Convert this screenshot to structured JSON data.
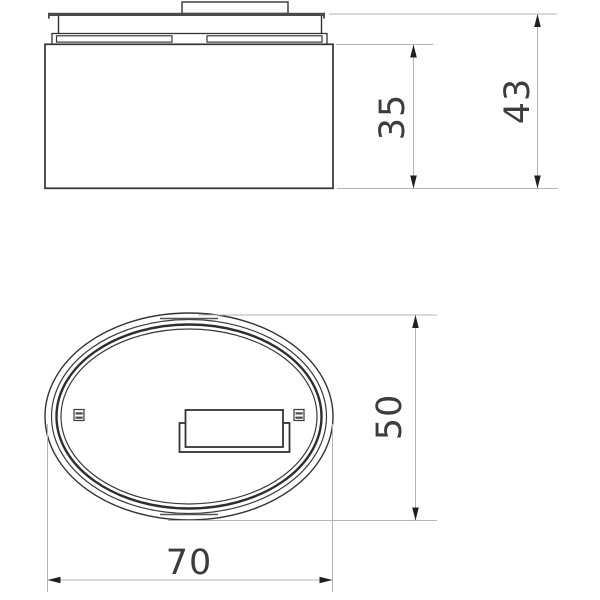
{
  "dimensions": {
    "side_inner_height": {
      "label": "35"
    },
    "side_total_height": {
      "label": "43"
    },
    "plan_minor_axis": {
      "label": "50"
    },
    "plan_major_axis": {
      "label": "70"
    }
  },
  "colors": {
    "object_line": "#333333",
    "cover_plate": "#4a4a4a",
    "dimension_line": "#b5b5b5",
    "arrowhead": "#1f1f1f",
    "label_text": "#3c3c3c",
    "background": "#ffffff"
  }
}
